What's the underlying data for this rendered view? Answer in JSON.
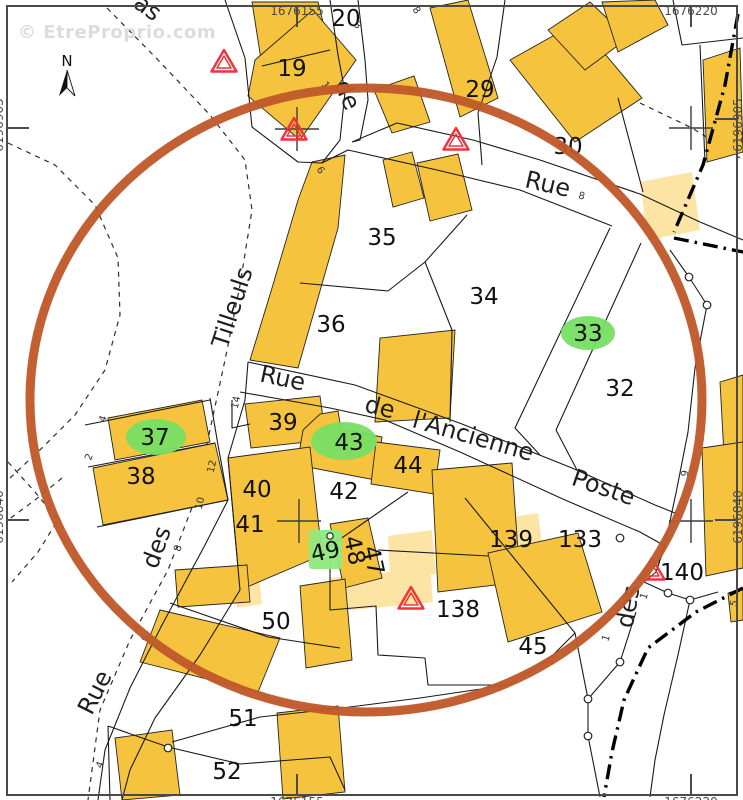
{
  "watermark": "© EtreProprio.com",
  "map": {
    "north_label": "N",
    "grid": {
      "top_left": "1676155",
      "top_right": "1676220",
      "bottom_left": "1676155",
      "bottom_right": "1676220",
      "left_top": "6196905",
      "left_bottom": "6196840",
      "right_top": "6196905",
      "right_bottom": "6196840"
    },
    "colors": {
      "building": "#F6C33E",
      "building_light": "#FBE4A4",
      "highlight_green": "#76DF63",
      "highlight_green_light": "#90E97F",
      "radius_circle": "#C05A2B",
      "triangle_red": "#F0323C",
      "parcel_line": "#1a1a1a",
      "frame": "#4a4a4a",
      "text": "#111111",
      "watermark": "#DCDCDC"
    },
    "parcels": [
      {
        "label": "19",
        "x": 292,
        "y": 76
      },
      {
        "label": "20",
        "x": 346,
        "y": 26
      },
      {
        "label": "29",
        "x": 480,
        "y": 97
      },
      {
        "label": "30",
        "x": 568,
        "y": 154
      },
      {
        "label": "35",
        "x": 382,
        "y": 245
      },
      {
        "label": "36",
        "x": 331,
        "y": 332
      },
      {
        "label": "34",
        "x": 484,
        "y": 304
      },
      {
        "label": "33",
        "x": 588,
        "y": 341,
        "highlight": "ellipse",
        "hl": {
          "cx": 588,
          "cy": 333,
          "rx": 27,
          "ry": 17
        }
      },
      {
        "label": "32",
        "x": 620,
        "y": 396
      },
      {
        "label": "37",
        "x": 155,
        "y": 445,
        "highlight": "ellipse",
        "hl": {
          "cx": 156,
          "cy": 437,
          "rx": 30,
          "ry": 18
        }
      },
      {
        "label": "38",
        "x": 141,
        "y": 484
      },
      {
        "label": "39",
        "x": 283,
        "y": 430
      },
      {
        "label": "43",
        "x": 349,
        "y": 450,
        "highlight": "ellipse",
        "hl": {
          "cx": 344,
          "cy": 441,
          "rx": 33,
          "ry": 19
        }
      },
      {
        "label": "44",
        "x": 408,
        "y": 473
      },
      {
        "label": "42",
        "x": 344,
        "y": 499
      },
      {
        "label": "40",
        "x": 257,
        "y": 497
      },
      {
        "label": "41",
        "x": 250,
        "y": 532
      },
      {
        "label": "49",
        "x": 327,
        "y": 559,
        "rot": -12,
        "highlight": "rect",
        "hl": {
          "x": 309,
          "y": 530,
          "w": 33,
          "h": 39
        }
      },
      {
        "label": "48",
        "x": 347,
        "y": 552,
        "rot": 78
      },
      {
        "label": "47",
        "x": 366,
        "y": 562,
        "rot": 78
      },
      {
        "label": "50",
        "x": 276,
        "y": 629
      },
      {
        "label": "51",
        "x": 243,
        "y": 726
      },
      {
        "label": "52",
        "x": 227,
        "y": 779
      },
      {
        "label": "45",
        "x": 533,
        "y": 654
      },
      {
        "label": "138",
        "x": 458,
        "y": 617
      },
      {
        "label": "139",
        "x": 511,
        "y": 547
      },
      {
        "label": "133",
        "x": 580,
        "y": 547
      },
      {
        "label": "140",
        "x": 682,
        "y": 580
      }
    ],
    "streets": [
      {
        "label": "as",
        "x": 143,
        "y": 14,
        "rot": 36
      },
      {
        "label": "de",
        "x": 340,
        "y": 98,
        "rot": 66
      },
      {
        "label": "Rue",
        "x": 546,
        "y": 192,
        "rot": 13
      },
      {
        "label": "Rue",
        "x": 281,
        "y": 386,
        "rot": 12
      },
      {
        "label": "de",
        "x": 378,
        "y": 415,
        "rot": 14
      },
      {
        "label": "l'Ancienne",
        "x": 471,
        "y": 444,
        "rot": 16
      },
      {
        "label": "Poste",
        "x": 601,
        "y": 495,
        "rot": 19
      },
      {
        "label": "Tilleuls",
        "x": 240,
        "y": 310,
        "rot": -72
      },
      {
        "label": "des",
        "x": 164,
        "y": 550,
        "rot": -70
      },
      {
        "label": "Rue",
        "x": 102,
        "y": 696,
        "rot": -63
      },
      {
        "label": "des",
        "x": 636,
        "y": 608,
        "rot": -80
      }
    ],
    "house_numbers": [
      {
        "label": "3",
        "x": 355,
        "y": 27,
        "rot": 55
      },
      {
        "label": "8",
        "x": 414,
        "y": 12,
        "rot": 55
      },
      {
        "label": "1",
        "x": 323,
        "y": 87,
        "rot": 55
      },
      {
        "label": "8",
        "x": 581,
        "y": 199,
        "rot": 13
      },
      {
        "label": "6",
        "x": 318,
        "y": 172,
        "rot": 55
      },
      {
        "label": "14",
        "x": 239,
        "y": 403,
        "rot": -78
      },
      {
        "label": "4",
        "x": 106,
        "y": 420,
        "rot": -70
      },
      {
        "label": "2",
        "x": 92,
        "y": 458,
        "rot": -70
      },
      {
        "label": "12",
        "x": 215,
        "y": 467,
        "rot": -78
      },
      {
        "label": "10",
        "x": 203,
        "y": 504,
        "rot": -78
      },
      {
        "label": "8",
        "x": 181,
        "y": 549,
        "rot": -75
      },
      {
        "label": "6",
        "x": 148,
        "y": 639,
        "rot": -68
      },
      {
        "label": "4",
        "x": 103,
        "y": 766,
        "rot": -68
      },
      {
        "label": "9",
        "x": 688,
        "y": 474,
        "rot": -80
      },
      {
        "label": "1",
        "x": 647,
        "y": 597,
        "rot": -72
      },
      {
        "label": "1",
        "x": 609,
        "y": 639,
        "rot": -72
      },
      {
        "label": "5",
        "x": 737,
        "y": 604,
        "rot": -75
      }
    ]
  }
}
